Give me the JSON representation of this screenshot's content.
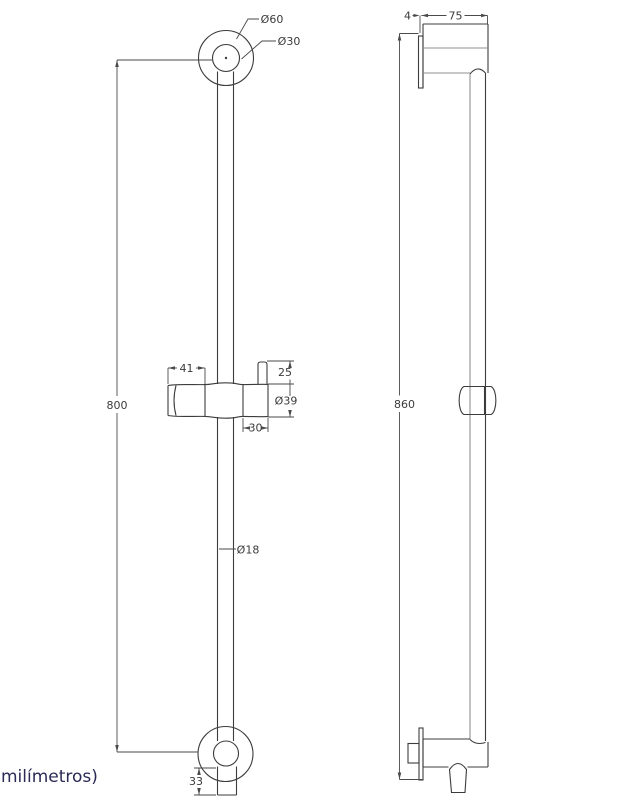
{
  "drawing": {
    "front_view": {
      "labels": {
        "dia_outer_flange": "Ø60",
        "dia_inner_flange": "Ø30",
        "bar_height": "800",
        "holder_left_width": "41",
        "pin_height": "25",
        "holder_diameter": "Ø39",
        "holder_right_width": "30",
        "tube_diameter": "Ø18",
        "outlet_height": "33"
      }
    },
    "side_view": {
      "labels": {
        "plate_thickness": "4",
        "flange_depth": "75",
        "overall_height": "860"
      }
    },
    "footer_note": "milímetros)",
    "colors": {
      "outline": "#3c3c3c",
      "secondary_line": "#8f8f8f",
      "dimension": "#4a4a4a",
      "note_text": "#2a2a55",
      "background": "#ffffff"
    }
  }
}
